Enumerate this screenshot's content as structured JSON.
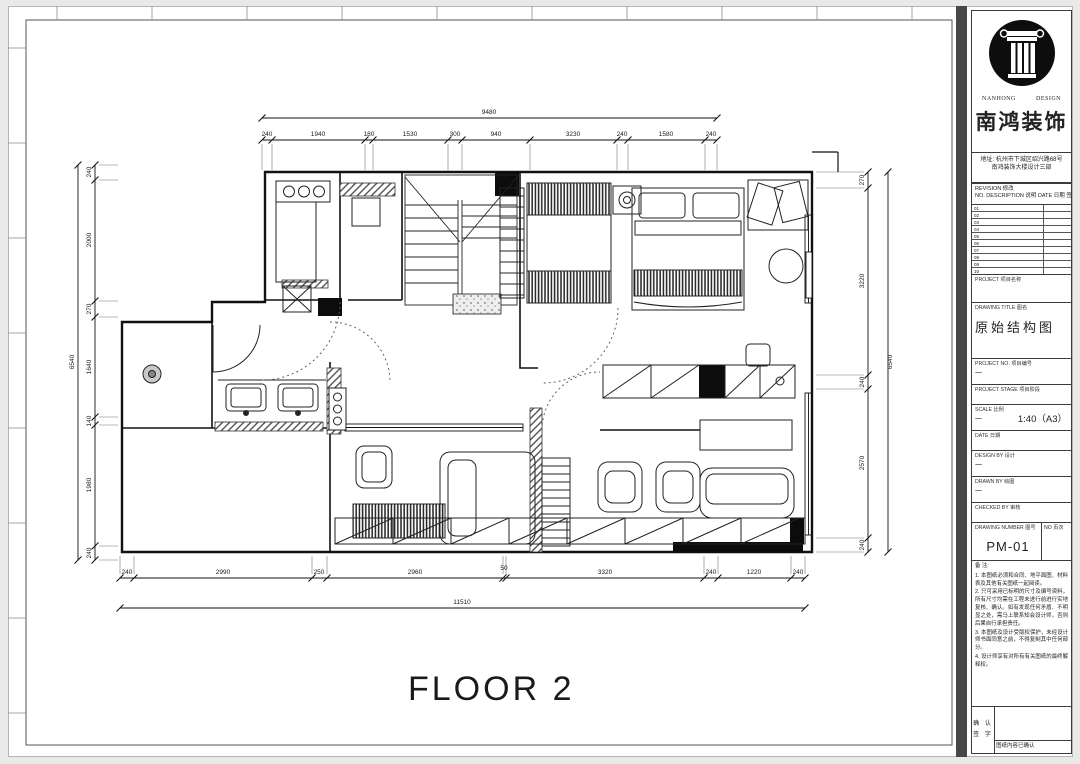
{
  "title_block": {
    "logo": {
      "en_left": "NANHONG",
      "en_right": "DESIGN",
      "cn": "南鸿装饰"
    },
    "address_line1": "地址: 杭州市下城区绍兴路68号",
    "address_line2": "南鸿装饰大楼设计三部",
    "revision_header_line1": "REVISION 修改",
    "revision_header_line2": "NO.  DESCRIPTION 说明  DATE 日期  签署",
    "revision_rows": [
      "01",
      "02",
      "03",
      "04",
      "05",
      "06",
      "07",
      "08",
      "09",
      "10"
    ],
    "project": {
      "label": "PROJECT  项目名称",
      "value": ""
    },
    "drawing_title": {
      "label": "DRAWING TITLE  图名",
      "value": "原始结构图"
    },
    "project_no": {
      "label": "PROJECT NO.  项目编号",
      "value": "一"
    },
    "project_stage": {
      "label": "PROJECT STAGE  项目阶段",
      "value": ""
    },
    "scale": {
      "label": "SCALE  比例",
      "value": "一",
      "value2": "1:40（A3）"
    },
    "date": {
      "label": "DATE  日期",
      "value": ""
    },
    "design_by": {
      "label": "DESIGN BY  设计",
      "value": "一"
    },
    "drawn_by": {
      "label": "DRAWN BY  绘图",
      "value": "一"
    },
    "checked_by": {
      "label": "CHECKED BY  审核",
      "value": ""
    },
    "drawing_number": {
      "label": "DRAWING NUMBER  图号",
      "value": "PM-01",
      "no_label": "NO  页次"
    },
    "notes_title": "备 注:",
    "notes": [
      "1. 本图纸必须和合同、地平面图、材料表及其他有关图纸一起阅读。",
      "2. 只可采用已标明的尺寸及编号资料，所有尺寸均需在工程未进行前进行实地复核、确认。如有发现任何矛盾、不明显之处，需马上联系知会设计师，否则后果自行承担责任。",
      "3. 本图纸及设计受版权保护，未经设计师书面同意之前，不得复制其中任何部分。",
      "4. 设计师享有对所有有关图纸的最终解释权。"
    ],
    "signoff": {
      "left_line1": "确 认",
      "left_line2": "签 字",
      "bottom": "图纸内容已确认"
    }
  },
  "drawing": {
    "floor_label": "FLOOR 2",
    "dims": {
      "top": {
        "overall": "9480",
        "segments": [
          "240",
          "1940",
          "180",
          "1530",
          "300",
          "940",
          "3230",
          "240",
          "1580",
          "240"
        ]
      },
      "bottom": {
        "overall": "11510",
        "segments": [
          "240",
          "2990",
          "250",
          "2960",
          "50",
          "3320",
          "240",
          "1220",
          "240"
        ]
      },
      "left": {
        "overall": "6540",
        "segments": [
          "240",
          "2000",
          "270",
          "1640",
          "140",
          "1980",
          "240"
        ]
      },
      "right": {
        "overall": "6540",
        "segments": [
          "270",
          "3220",
          "240",
          "2570",
          "240"
        ]
      }
    }
  }
}
